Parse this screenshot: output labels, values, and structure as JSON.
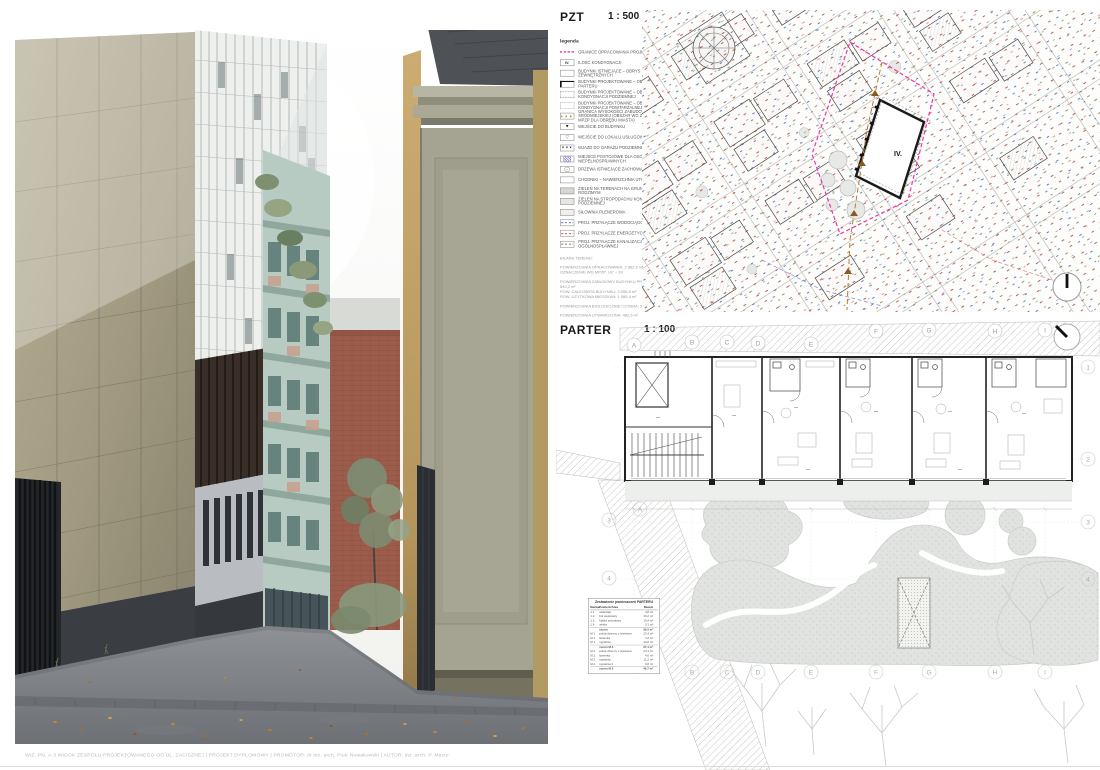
{
  "palette": {
    "boundary_magenta": "#f032a8",
    "height_line_orange": "#c8822e",
    "water_blue": "#4a62c8",
    "power_red": "#c84a4a",
    "sewer_brown": "#9a6a3a",
    "site_outline_black": "#1a1a1a",
    "garden_green_gray": "#e0e3e0",
    "render_olive_wall": "#a09a80",
    "render_green_facade": "#b7cbc2",
    "render_brick": "#9c5c4b",
    "render_tan_building": "#c2a46b",
    "render_road": "#7c8086"
  },
  "pzt": {
    "title": "PZT",
    "scale": "1 : 500",
    "legend_heading": "legenda",
    "site_label": "IV.",
    "legend": [
      {
        "label": "GRANICE OPRACOWANIA PROJEKTU"
      },
      {
        "swatch_text": "IV.",
        "label": "ILOŚĆ KONDYGNACJI"
      },
      {
        "label": "BUDYNKI ISTNIEJĄCE – OBRYS ŚCIAN ZEWNĘTRZNYCH"
      },
      {
        "label": "BUDYNKI PROJEKTOWANE – OBRYS PARTERU"
      },
      {
        "label": "BUDYNKI PROJEKTOWANE – OBRYS KONDYGNACJI PODZIEMNEJ"
      },
      {
        "label": "BUDYNKI PROJEKTOWANE – OBRYS KONDYGNACJI POWTARZALNEJ"
      },
      {
        "label": "GRANICA WYSOKOŚCI ZABUDOWY ŚRÓDMIEJSKIEJ (OBSZAR WG ZAPISÓW MPZP DLA OBRĘBU MIASTA)"
      },
      {
        "label": "WEJŚCIE DO BUDYNKU"
      },
      {
        "label": "WEJŚCIE DO LOKALU USŁUGOWEGO"
      },
      {
        "label": "WJAZD DO GARAŻU PODZIEMNEGO"
      },
      {
        "label": "MIEJSCE POSTOJOWE DLA OSÓB NIEPEŁNOSPRAWNYCH"
      },
      {
        "label": "DRZEWA ISTNIEJĄCE ZACHOWANE"
      },
      {
        "label": "CHODNIKI – NAWIERZCHNIA UTWARDZONA"
      },
      {
        "label": "ZIELEŃ NA TERENACH NA GRUNCIE RODZIMYM"
      },
      {
        "label": "ZIELEŃ NA STROPODACHU KONDYGNACJI PODZIEMNEJ"
      },
      {
        "label": "SIŁOWNIA PLENEROWA"
      },
      {
        "label": "PROJ. PRZYŁĄCZE WODOCIĄGOWE"
      },
      {
        "label": "PROJ. PRZYŁĄCZE ENERGETYCZNE"
      },
      {
        "label": "PROJ. PRZYŁĄCZE KANALIZACJI OGÓLNOSPŁAWNEJ"
      }
    ],
    "notes": [
      "BILANS TERENU:",
      "POWIERZCHNIA OPRACOWANIA: 2 862,5 m²",
      "OZNACZENIE WG MPZP: UC – 33",
      "POWIERZCHNIA ZABUDOWY BUDYNKU PROJ.: 640,2 m²",
      "POW. CAŁKOWITA BUDYNKU: 3 056,8 m²",
      "POW. UŻYTKOWA MIESZKAŃ: 1 985,4 m²",
      "POWIERZCHNIA BIOLOGICZNIE CZYNNA: 34,2%",
      "POWIERZCHNIA UTWARDZONA: 482,6 m²"
    ]
  },
  "parter": {
    "title": "PARTER",
    "scale": "1 : 100",
    "grid_columns": [
      "A",
      "B",
      "C",
      "D",
      "E",
      "F",
      "G",
      "H",
      "I"
    ],
    "grid_rows": [
      "1",
      "2",
      "3",
      "4"
    ],
    "table": {
      "title": "Zestawienie pomieszczeń PARTERU",
      "columns": [
        "Nazwa",
        "Powierzchnia",
        "Razem"
      ],
      "rows": [
        [
          "1.1",
          "wiatrołap",
          "4,8 m²"
        ],
        [
          "1.2",
          "hol wejściowy",
          "16,2 m²"
        ],
        [
          "1.3",
          "klatka schodowa",
          "15,4 m²"
        ],
        [
          "1.4",
          "winda",
          "3,1 m²"
        ],
        [
          "",
          "razem",
          "39,5 m²"
        ],
        [
          "M.1",
          "pokój dzienny z aneksem",
          "22,4 m²"
        ],
        [
          "M.1",
          "łazienka",
          "4,2 m²"
        ],
        [
          "M.1",
          "sypialnia",
          "10,8 m²"
        ],
        [
          "",
          "razem M.1",
          "37,4 m²"
        ],
        [
          "M.2",
          "pokój dzienny z aneksem",
          "24,1 m²"
        ],
        [
          "M.2",
          "łazienka",
          "4,6 m²"
        ],
        [
          "M.2",
          "sypialnia",
          "11,2 m²"
        ],
        [
          "M.2",
          "sypialnia 2",
          "9,8 m²"
        ],
        [
          "",
          "razem M.2",
          "49,7 m²"
        ]
      ]
    }
  },
  "footer": {
    "caption": "WIZ. PN. A-3  WIDOK ZESPOŁU PROJEKTOWANEGO OD UL. ZACISZNEJ  |  PROJEKT DYPLOMOWY  |  PROMOTOR: dr inż. arch. Piotr Nowakowski  |  AUTOR: inż. arch. P. Mazur"
  }
}
